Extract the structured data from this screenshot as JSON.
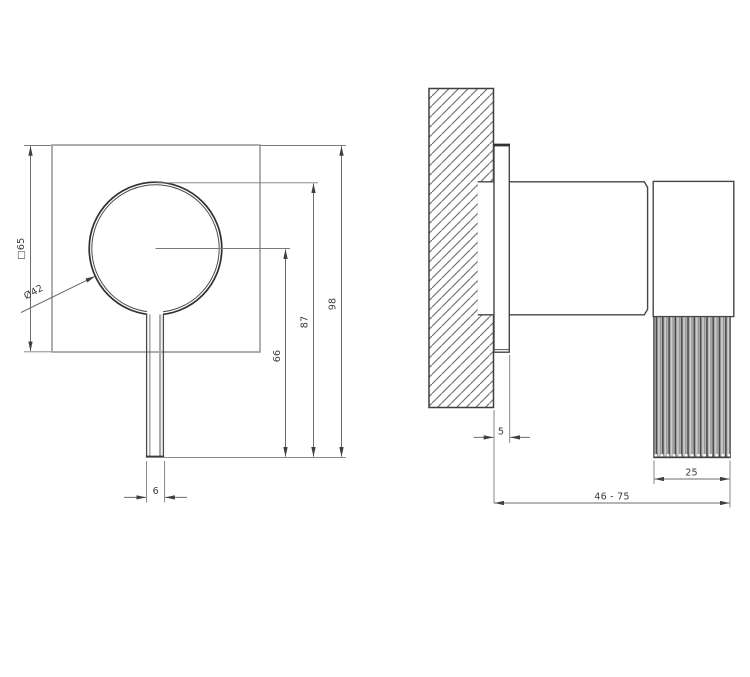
{
  "drawing": {
    "kind": "technical dimension drawing, front and side view",
    "front_view": {
      "dimensions": {
        "square_plate": "□65",
        "knob_diameter": "Ø42",
        "center_to_lever_tip": "66",
        "knob_top_to_lever_tip": "87",
        "overall_height": "98",
        "lever_width": "6"
      }
    },
    "side_view": {
      "dimensions": {
        "plate_thickness": "5",
        "knurled_grip_depth": "25",
        "wall_projection_range": "46 - 75"
      }
    },
    "colors": {
      "background": "#ffffff",
      "object_outline": "#474747",
      "light_outline": "#949494",
      "dimension_line": "#6b6b6b",
      "text": "#3c3c3c",
      "hatch_line": "#5d5d5d",
      "knurl_fill": "#b2b2b2",
      "knurl_dark": "#464646",
      "knurl_light": "#d8d8d8"
    }
  }
}
